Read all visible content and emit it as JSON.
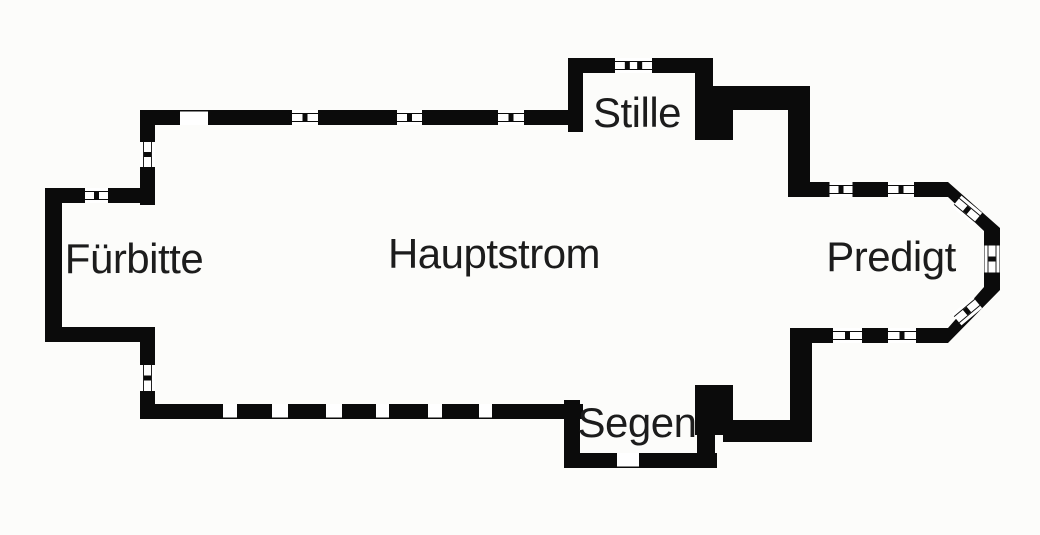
{
  "figure": {
    "type": "church-floorplan-diagram"
  },
  "colors": {
    "background": "#fcfcfa",
    "wall": "#0b0b0b",
    "opening": "#ffffff",
    "label": "#1c1c1c"
  },
  "canvas": {
    "width": 1040,
    "height": 535
  },
  "rooms": [
    {
      "id": "fuerbitte",
      "label": "Fürbitte",
      "cx": 134,
      "cy": 259
    },
    {
      "id": "hauptstrom",
      "label": "Hauptstrom",
      "cx": 494,
      "cy": 254
    },
    {
      "id": "stille",
      "label": "Stille",
      "cx": 637,
      "cy": 113
    },
    {
      "id": "segen",
      "label": "Segen",
      "cx": 637,
      "cy": 423
    },
    {
      "id": "predigt",
      "label": "Predigt",
      "cx": 891,
      "cy": 257
    }
  ],
  "floorplan": {
    "wall_thickness": 15,
    "walls": [
      {
        "id": "annex-west-wall",
        "x": 45,
        "y": 188,
        "w": 17,
        "h": 154
      },
      {
        "id": "annex-north-wall",
        "x": 45,
        "y": 188,
        "w": 100,
        "h": 15
      },
      {
        "id": "annex-south-wall",
        "x": 45,
        "y": 327,
        "w": 110,
        "h": 15
      },
      {
        "id": "nave-west-wall-upper",
        "x": 140,
        "y": 110,
        "w": 15,
        "h": 95
      },
      {
        "id": "nave-west-wall-lower",
        "x": 140,
        "y": 327,
        "w": 15,
        "h": 92
      },
      {
        "id": "nave-north-wall",
        "x": 140,
        "y": 110,
        "w": 443,
        "h": 15
      },
      {
        "id": "nave-south-wall",
        "x": 140,
        "y": 404,
        "w": 443,
        "h": 15
      },
      {
        "id": "north-porch-top-wall",
        "x": 568,
        "y": 58,
        "w": 145,
        "h": 15
      },
      {
        "id": "north-porch-left-wall",
        "x": 568,
        "y": 58,
        "w": 15,
        "h": 74
      },
      {
        "id": "north-porch-right-wall",
        "x": 695,
        "y": 58,
        "w": 18,
        "h": 82
      },
      {
        "id": "north-porch-pier",
        "x": 695,
        "y": 103,
        "w": 38,
        "h": 37
      },
      {
        "id": "north-step-wall",
        "x": 705,
        "y": 86,
        "w": 105,
        "h": 24
      },
      {
        "id": "north-shoulder-wall",
        "x": 788,
        "y": 86,
        "w": 22,
        "h": 106
      },
      {
        "id": "chancel-north-wall",
        "x": 788,
        "y": 182,
        "w": 160,
        "h": 15
      },
      {
        "id": "chancel-south-wall",
        "x": 790,
        "y": 328,
        "w": 158,
        "h": 15
      },
      {
        "id": "south-shoulder-wall",
        "x": 790,
        "y": 328,
        "w": 22,
        "h": 114
      },
      {
        "id": "south-step-wall",
        "x": 723,
        "y": 420,
        "w": 89,
        "h": 22
      },
      {
        "id": "south-porch-pier",
        "x": 695,
        "y": 385,
        "w": 38,
        "h": 50
      },
      {
        "id": "south-porch-right-wall",
        "x": 697,
        "y": 385,
        "w": 18,
        "h": 83
      },
      {
        "id": "south-porch-bottom-wall",
        "x": 564,
        "y": 453,
        "w": 153,
        "h": 15
      },
      {
        "id": "south-porch-left-wall",
        "x": 564,
        "y": 400,
        "w": 16,
        "h": 68
      }
    ],
    "apse_path": "M948,182 L1000,228 L1000,290 L948,343 L948,328 L984,287 L984,231 L948,197 Z",
    "windows": [
      {
        "id": "nave-north-window-1",
        "cx": 305,
        "cy": 117.5,
        "len": 26,
        "angle": 0,
        "marks": 1
      },
      {
        "id": "nave-north-window-2",
        "cx": 409.5,
        "cy": 117.5,
        "len": 25,
        "angle": 0,
        "marks": 1
      },
      {
        "id": "nave-north-window-3",
        "cx": 511,
        "cy": 117.5,
        "len": 26,
        "angle": 0,
        "marks": 1
      },
      {
        "id": "annex-north-window",
        "cx": 96.5,
        "cy": 195.5,
        "len": 23,
        "angle": 0,
        "marks": 1
      },
      {
        "id": "west-wall-window-upper",
        "cx": 147.5,
        "cy": 154.5,
        "len": 25,
        "angle": 90,
        "marks": 1
      },
      {
        "id": "west-wall-window-lower",
        "cx": 147.5,
        "cy": 378,
        "len": 26,
        "angle": 90,
        "marks": 1
      },
      {
        "id": "north-porch-window",
        "cx": 633.5,
        "cy": 65.5,
        "len": 37,
        "angle": 0,
        "marks": 2
      },
      {
        "id": "chancel-north-window-1",
        "cx": 841,
        "cy": 189.5,
        "len": 23,
        "angle": 0,
        "marks": 1
      },
      {
        "id": "chancel-north-window-2",
        "cx": 901,
        "cy": 189.5,
        "len": 26,
        "angle": 0,
        "marks": 1
      },
      {
        "id": "chancel-south-window-1",
        "cx": 847.5,
        "cy": 335.5,
        "len": 29,
        "angle": 0,
        "marks": 1
      },
      {
        "id": "chancel-south-window-2",
        "cx": 902,
        "cy": 335.5,
        "len": 28,
        "angle": 0,
        "marks": 1
      },
      {
        "id": "apse-northeast-window",
        "cx": 967,
        "cy": 210,
        "len": 27,
        "angle": 40,
        "marks": 1
      },
      {
        "id": "apse-east-window",
        "cx": 992,
        "cy": 259,
        "len": 27,
        "angle": 90,
        "marks": 1
      },
      {
        "id": "apse-southeast-window",
        "cx": 967,
        "cy": 311,
        "len": 27,
        "angle": -40,
        "marks": 1
      }
    ],
    "doors": [
      {
        "id": "nave-north-door",
        "x": 180,
        "y": 110,
        "w": 28,
        "h": 15,
        "edge": "top"
      },
      {
        "id": "nave-south-gap-1",
        "x": 223,
        "y": 404,
        "w": 14,
        "h": 15,
        "edge": "bottom"
      },
      {
        "id": "nave-south-gap-2",
        "x": 272,
        "y": 404,
        "w": 16,
        "h": 15,
        "edge": "bottom"
      },
      {
        "id": "nave-south-gap-3",
        "x": 326,
        "y": 404,
        "w": 16,
        "h": 15,
        "edge": "bottom"
      },
      {
        "id": "nave-south-gap-4",
        "x": 376,
        "y": 404,
        "w": 13,
        "h": 15,
        "edge": "bottom"
      },
      {
        "id": "nave-south-gap-5",
        "x": 428,
        "y": 404,
        "w": 14,
        "h": 15,
        "edge": "bottom"
      },
      {
        "id": "nave-south-gap-6",
        "x": 479,
        "y": 404,
        "w": 13,
        "h": 15,
        "edge": "bottom"
      },
      {
        "id": "south-porch-door",
        "x": 617,
        "y": 453,
        "w": 22,
        "h": 15,
        "edge": "bottom"
      }
    ]
  }
}
